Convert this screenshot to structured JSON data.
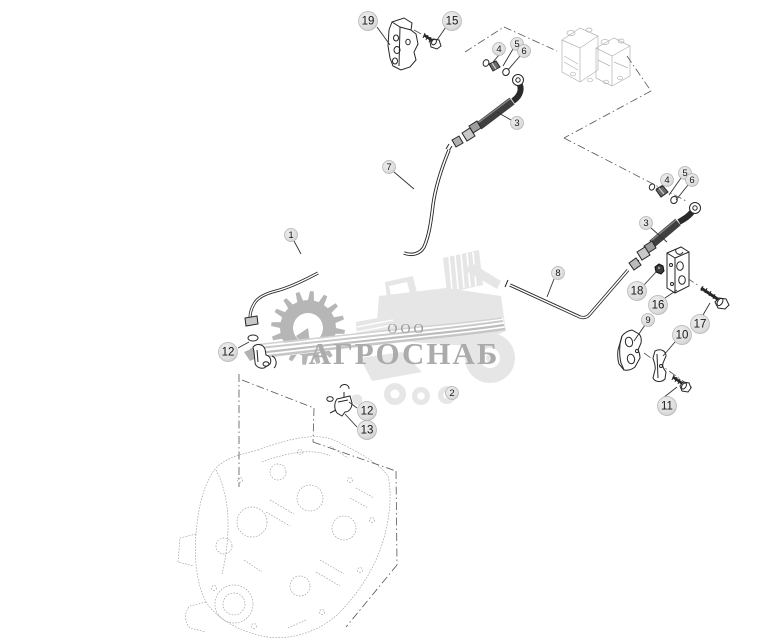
{
  "watermark": {
    "company_prefix": "ООО",
    "company_name": "АГРОСНАБ"
  },
  "colors": {
    "line_ink": "#262626",
    "braid_dark": "#3f3f3f",
    "callout_fill_light": "#ececec",
    "callout_fill_dark": "#cccccc",
    "callout_border": "#b2b2b2",
    "callout_number": "#161616",
    "watermark_gear": "#b6b6b6",
    "watermark_harvester": "#e6e6e6",
    "watermark_swoosh": "#c6c6c6",
    "watermark_text": "#ababab",
    "sketch_gray": "#9b9b9b",
    "boundary_gray": "#555555"
  },
  "callouts": [
    {
      "label": "19",
      "x": 368,
      "y": 21,
      "size": "lg",
      "leader": [
        377,
        27,
        390,
        45
      ]
    },
    {
      "label": "15",
      "x": 452,
      "y": 21,
      "size": "lg",
      "leader": [
        446,
        27,
        437,
        40
      ]
    },
    {
      "label": "4",
      "x": 499,
      "y": 49,
      "size": "sm",
      "leader": [
        499,
        55,
        493,
        62
      ]
    },
    {
      "label": "5",
      "x": 517,
      "y": 44,
      "size": "sm",
      "leader": [
        513,
        49,
        503,
        66
      ]
    },
    {
      "label": "6",
      "x": 524,
      "y": 51,
      "size": "sm",
      "leader": [
        520,
        56,
        508,
        70
      ]
    },
    {
      "label": "3",
      "x": 517,
      "y": 123,
      "size": "sm",
      "leader": [
        511,
        120,
        497,
        112
      ]
    },
    {
      "label": "7",
      "x": 389,
      "y": 167,
      "size": "sm",
      "leader": [
        394,
        172,
        414,
        189
      ]
    },
    {
      "label": "1",
      "x": 291,
      "y": 235,
      "size": "sm",
      "leader": [
        294,
        241,
        301,
        254
      ]
    },
    {
      "label": "12",
      "x": 228,
      "y": 352,
      "size": "lg",
      "leader": [
        238,
        348,
        249,
        342
      ]
    },
    {
      "label": "2",
      "x": 452,
      "y": 393,
      "size": "sm",
      "leader": null
    },
    {
      "label": "12",
      "x": 367,
      "y": 411,
      "size": "lg",
      "leader": [
        357,
        408,
        349,
        402
      ]
    },
    {
      "label": "13",
      "x": 367,
      "y": 430,
      "size": "lg",
      "leader": [
        357,
        427,
        345,
        414
      ]
    },
    {
      "label": "8",
      "x": 558,
      "y": 273,
      "size": "sm",
      "leader": [
        554,
        279,
        547,
        297
      ]
    },
    {
      "label": "4",
      "x": 667,
      "y": 180,
      "size": "sm",
      "leader": [
        663,
        185,
        656,
        189
      ]
    },
    {
      "label": "5",
      "x": 685,
      "y": 173,
      "size": "sm",
      "leader": [
        681,
        178,
        669,
        195
      ]
    },
    {
      "label": "6",
      "x": 692,
      "y": 180,
      "size": "sm",
      "leader": [
        688,
        185,
        676,
        200
      ]
    },
    {
      "label": "3",
      "x": 646,
      "y": 223,
      "size": "sm",
      "leader": [
        651,
        228,
        667,
        242
      ]
    },
    {
      "label": "18",
      "x": 637,
      "y": 291,
      "size": "lg",
      "leader": [
        644,
        285,
        656,
        272
      ]
    },
    {
      "label": "16",
      "x": 658,
      "y": 305,
      "size": "lg",
      "leader": [
        665,
        298,
        677,
        290
      ]
    },
    {
      "label": "17",
      "x": 700,
      "y": 324,
      "size": "lg",
      "leader": [
        703,
        315,
        710,
        303
      ]
    },
    {
      "label": "9",
      "x": 648,
      "y": 320,
      "size": "sm",
      "leader": [
        645,
        325,
        634,
        341
      ]
    },
    {
      "label": "10",
      "x": 682,
      "y": 335,
      "size": "lg",
      "leader": [
        675,
        342,
        663,
        356
      ]
    },
    {
      "label": "11",
      "x": 667,
      "y": 406,
      "size": "lg",
      "leader": [
        663,
        398,
        677,
        387
      ]
    }
  ]
}
